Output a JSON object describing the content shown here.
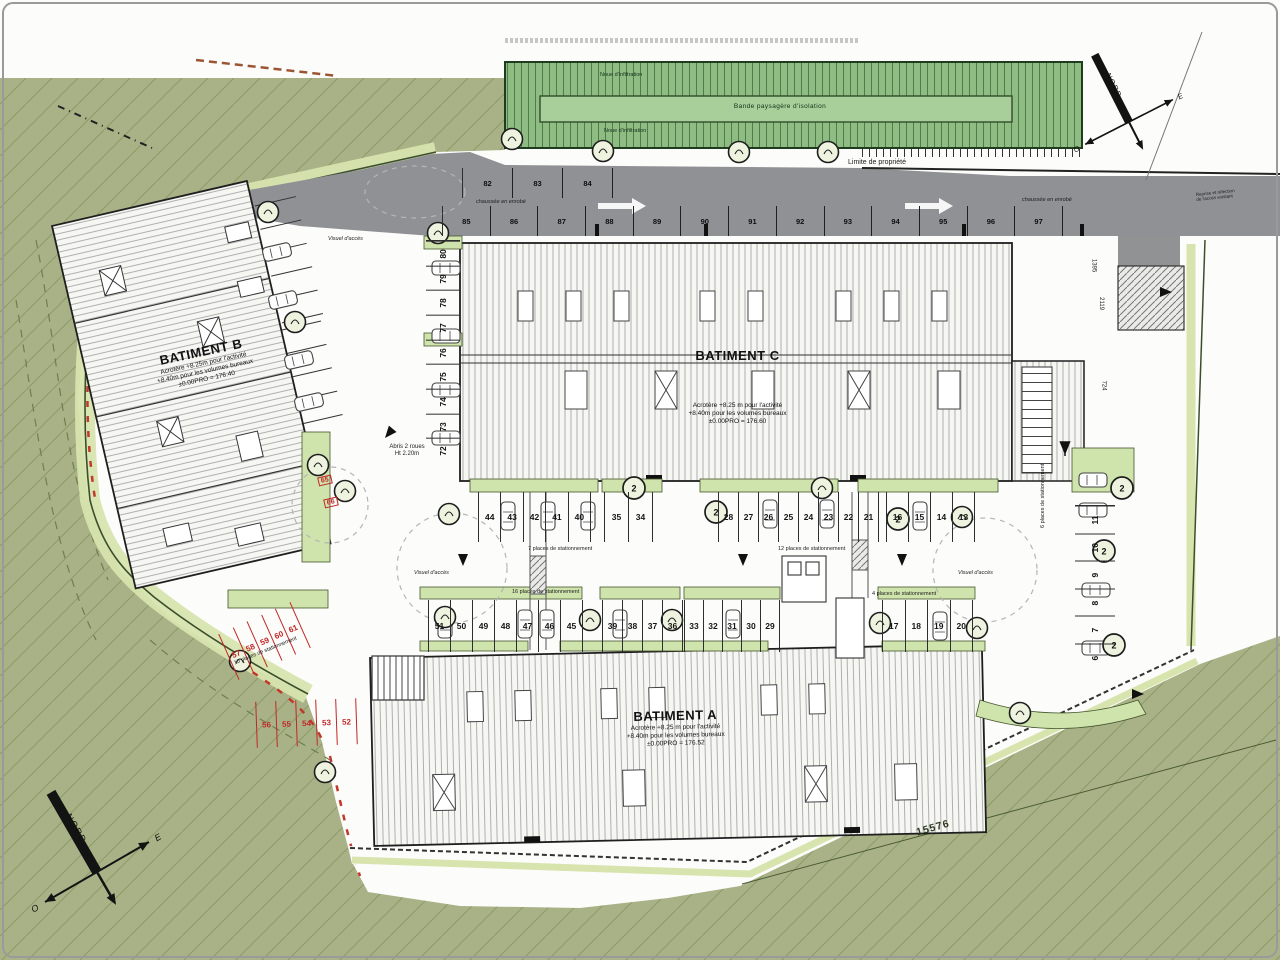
{
  "plan": {
    "buildings": {
      "a": {
        "name": "BATIMENT A",
        "acrotere": "Acrotère +8.25 m pour l'activité",
        "volumes": "+8.40m pour les volumes bureaux",
        "niveau": "±0.00PRO = 176.52"
      },
      "b": {
        "name": "BATIMENT B",
        "acrotere": "Acrotère +8.25m pour l'activité",
        "volumes": "+8.40m pour les volumes bureaux",
        "niveau": "±0.00PRO = 176.40"
      },
      "c": {
        "name": "BATIMENT C",
        "acrotere": "Acrotère +8.25 m pour l'activité",
        "volumes": "+8.40m pour les volumes bureaux",
        "niveau": "±0.00PRO = 176.60"
      }
    },
    "road": {
      "limite": "Limite de propriété",
      "chaussee_left": "chaussée en enrobé",
      "chaussee_right": "chaussée en enrobé",
      "stalls_top": [
        "82",
        "83",
        "84"
      ],
      "stalls_bottom": [
        "85",
        "86",
        "87",
        "88",
        "89",
        "90",
        "91",
        "92",
        "93",
        "94",
        "95",
        "96",
        "97"
      ]
    },
    "landscape": {
      "band_center": "Bande paysagère d'isolation",
      "noue_top": "Noue d'infiltration",
      "noue_bottom": "Noue d'infiltration"
    },
    "parking": {
      "row_upper_1": [
        "44",
        "43",
        "42",
        "41",
        "40"
      ],
      "row_upper_2": [
        "35",
        "34"
      ],
      "row_upper_3": [
        "28",
        "27",
        "26",
        "25",
        "24",
        "23",
        "22",
        "21"
      ],
      "row_upper_4": [
        "16",
        "15",
        "14",
        "13"
      ],
      "row_lower_1": [
        "51",
        "50",
        "49",
        "48",
        "47",
        "46",
        "45"
      ],
      "row_lower_2": [
        "39",
        "38",
        "37",
        "36"
      ],
      "row_lower_3": [
        "33",
        "32",
        "31",
        "30",
        "29"
      ],
      "row_lower_4": [
        "17",
        "18",
        "19",
        "20"
      ],
      "red_upper": [
        "57",
        "58",
        "59",
        "60",
        "61"
      ],
      "red_lower": [
        "56",
        "55",
        "54",
        "53",
        "52"
      ],
      "col_west": [
        "80",
        "79",
        "78",
        "77",
        "76",
        "75",
        "74",
        "73",
        "72"
      ],
      "col_east": [
        "11",
        "10",
        "9",
        "8",
        "7",
        "6"
      ],
      "red_small_1": "65",
      "red_small_2": "66",
      "count_7": "7 places de stationnement",
      "count_12": "12 places de stationnement",
      "count_16": "16 places de stationnement",
      "count_4": "4 places de stationnement",
      "count_10": "10 places de stationnement",
      "count_6": "6 places de stationnement"
    },
    "annotations": {
      "abris": "Abris 2 roues",
      "abris_h": "Ht 2.20m",
      "visuel_1": "Visuel d'accès",
      "visuel_2": "Visuel d'accès",
      "visuel_3": "Visuel d'accès",
      "parcel": "15576",
      "dim_1": "2119",
      "dim_2": "724",
      "dim_3": "1395",
      "note_right_1": "Reprise et réfection",
      "note_right_2": "de l'accès existant",
      "tree_ref": "2"
    },
    "compass": {
      "nord": "NORD",
      "est": "E",
      "ouest": "O"
    }
  }
}
